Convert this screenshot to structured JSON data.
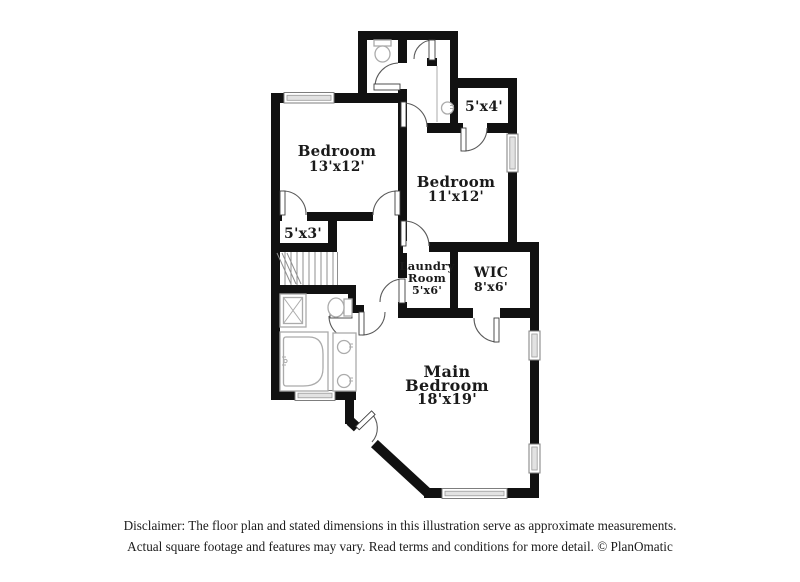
{
  "rooms": {
    "bedroom_13x12": {
      "name": "Bedroom",
      "dims": "13'x12'"
    },
    "bedroom_11x12": {
      "name": "Bedroom",
      "dims": "11'x12'"
    },
    "closet_5x4": {
      "dims": "5'x4'"
    },
    "closet_5x3": {
      "dims": "5'x3'"
    },
    "laundry": {
      "name_line1": "Laundry",
      "name_line2": "Room",
      "dims": "5'x6'"
    },
    "wic": {
      "name": "WIC",
      "dims": "8'x6'"
    },
    "main_bedroom": {
      "name_line1": "Main",
      "name_line2": "Bedroom",
      "dims": "18'x19'"
    }
  },
  "fixtures": [
    "toilet",
    "toilet",
    "sink",
    "double-sink-vanity",
    "bathtub",
    "shower",
    "staircase"
  ],
  "disclaimer": {
    "line1": "Disclaimer: The floor plan and stated dimensions in this illustration serve as approximate measurements.",
    "line2": "Actual square footage and features may vary. Read terms and conditions for more detail. © PlanOmatic"
  },
  "colors": {
    "wall": "#111111",
    "fixture": "#ababab",
    "window_frame": "#7d7d7d",
    "door_arc": "#5a5a5a",
    "text": "#1a1a1a",
    "bg": "#ffffff"
  }
}
